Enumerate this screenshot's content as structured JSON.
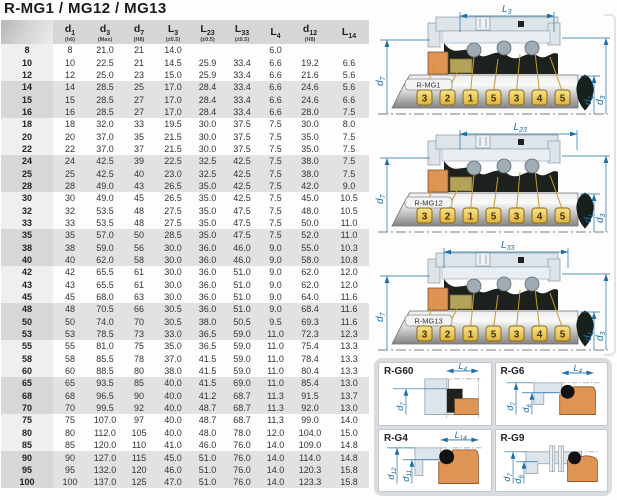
{
  "title": "R-MG1 / MG12 / MG13",
  "table": {
    "columns": [
      {
        "main": "",
        "sub": "",
        "note": ""
      },
      {
        "main": "d",
        "sub": "1",
        "note": "(h6)"
      },
      {
        "main": "d",
        "sub": "3",
        "note": "(Max)"
      },
      {
        "main": "d",
        "sub": "7",
        "note": "(H8)"
      },
      {
        "main": "L",
        "sub": "3",
        "note": "(±0.5)"
      },
      {
        "main": "L",
        "sub": "23",
        "note": "(±0.5)"
      },
      {
        "main": "L",
        "sub": "33",
        "note": "(±0.5)"
      },
      {
        "main": "L",
        "sub": "4",
        "note": ""
      },
      {
        "main": "d",
        "sub": "12",
        "note": "(H8)"
      },
      {
        "main": "L",
        "sub": "14",
        "note": ""
      }
    ],
    "rows": [
      [
        "8",
        "8",
        "21.0",
        "21",
        "14.0",
        "",
        "",
        "6.0",
        "",
        ""
      ],
      [
        "10",
        "10",
        "22.5",
        "21",
        "14.5",
        "25.9",
        "33.4",
        "6.6",
        "19.2",
        "6.6"
      ],
      [
        "12",
        "12",
        "25.0",
        "23",
        "15.0",
        "25.9",
        "33.4",
        "6.6",
        "21.6",
        "5.6"
      ],
      [
        "14",
        "14",
        "28.5",
        "25",
        "17.0",
        "28.4",
        "33.4",
        "6.6",
        "24.6",
        "5.6"
      ],
      [
        "15",
        "15",
        "28.5",
        "27",
        "17.0",
        "28.4",
        "33.4",
        "6.6",
        "24.6",
        "6.6"
      ],
      [
        "16",
        "16",
        "28.5",
        "27",
        "17.0",
        "28.4",
        "33.4",
        "6.6",
        "28.0",
        "7.5"
      ],
      [
        "18",
        "18",
        "32.0",
        "33",
        "19.5",
        "30.0",
        "37.5",
        "7.5",
        "30.0",
        "8.0"
      ],
      [
        "20",
        "20",
        "37.0",
        "35",
        "21.5",
        "30.0",
        "37.5",
        "7.5",
        "35.0",
        "7.5"
      ],
      [
        "22",
        "22",
        "37.0",
        "37",
        "21.5",
        "30.0",
        "37.5",
        "7.5",
        "35.0",
        "7.5"
      ],
      [
        "24",
        "24",
        "42.5",
        "39",
        "22.5",
        "32.5",
        "42.5",
        "7.5",
        "38.0",
        "7.5"
      ],
      [
        "25",
        "25",
        "42.5",
        "40",
        "23.0",
        "32.5",
        "42.5",
        "7.5",
        "38.0",
        "7.5"
      ],
      [
        "28",
        "28",
        "49.0",
        "43",
        "26.5",
        "35.0",
        "42.5",
        "7.5",
        "42.0",
        "9.0"
      ],
      [
        "30",
        "30",
        "49.0",
        "45",
        "26.5",
        "35.0",
        "42.5",
        "7.5",
        "45.0",
        "10.5"
      ],
      [
        "32",
        "32",
        "53.5",
        "48",
        "27.5",
        "35.0",
        "47.5",
        "7.5",
        "48.0",
        "10.5"
      ],
      [
        "33",
        "33",
        "53.5",
        "48",
        "27.5",
        "35.0",
        "47.5",
        "7.5",
        "50.0",
        "11.0"
      ],
      [
        "35",
        "35",
        "57.0",
        "50",
        "28.5",
        "35.0",
        "47.5",
        "7.5",
        "52.0",
        "11.0"
      ],
      [
        "38",
        "38",
        "59.0",
        "56",
        "30.0",
        "36.0",
        "46.0",
        "9.0",
        "55.0",
        "10.3"
      ],
      [
        "40",
        "40",
        "62.0",
        "58",
        "30.0",
        "36.0",
        "46.0",
        "9.0",
        "58.0",
        "10.8"
      ],
      [
        "42",
        "42",
        "65.5",
        "61",
        "30.0",
        "36.0",
        "51.0",
        "9.0",
        "62.0",
        "12.0"
      ],
      [
        "43",
        "43",
        "65.5",
        "61",
        "30.0",
        "36.0",
        "51.0",
        "9.0",
        "62.0",
        "12.0"
      ],
      [
        "45",
        "45",
        "68.0",
        "63",
        "30.0",
        "36.0",
        "51.0",
        "9.0",
        "64.0",
        "11.6"
      ],
      [
        "48",
        "48",
        "70.5",
        "66",
        "30.5",
        "36.0",
        "51.0",
        "9.0",
        "68.4",
        "11.6"
      ],
      [
        "50",
        "50",
        "74.0",
        "70",
        "30.5",
        "38.0",
        "50.5",
        "9.5",
        "69.3",
        "11.6"
      ],
      [
        "53",
        "53",
        "78.5",
        "73",
        "33.0",
        "36.5",
        "59.0",
        "11.0",
        "72.3",
        "12.3"
      ],
      [
        "55",
        "55",
        "81.0",
        "75",
        "35.0",
        "36.5",
        "59.0",
        "11.0",
        "75.4",
        "13.3"
      ],
      [
        "58",
        "58",
        "85.5",
        "78",
        "37.0",
        "41.5",
        "59.0",
        "11.0",
        "78.4",
        "13.3"
      ],
      [
        "60",
        "60",
        "88.5",
        "80",
        "38.0",
        "41.5",
        "59.0",
        "11.0",
        "80.4",
        "13.3"
      ],
      [
        "65",
        "65",
        "93.5",
        "85",
        "40.0",
        "41.5",
        "69.0",
        "11.0",
        "85.4",
        "13.0"
      ],
      [
        "68",
        "68",
        "96.5",
        "90",
        "40.0",
        "41.2",
        "68.7",
        "11.3",
        "91.5",
        "13.7"
      ],
      [
        "70",
        "70",
        "99.5",
        "92",
        "40.0",
        "48.7",
        "68.7",
        "11.3",
        "92.0",
        "13.0"
      ],
      [
        "75",
        "75",
        "107.0",
        "97",
        "40.0",
        "48.7",
        "68.7",
        "11.3",
        "99.0",
        "14.0"
      ],
      [
        "80",
        "80",
        "112.0",
        "105",
        "40.0",
        "48.0",
        "78.0",
        "12.0",
        "104.0",
        "15.0"
      ],
      [
        "85",
        "85",
        "120.0",
        "110",
        "41.0",
        "46.0",
        "76.0",
        "14.0",
        "109.0",
        "14.8"
      ],
      [
        "90",
        "90",
        "127.0",
        "115",
        "45.0",
        "51.0",
        "76.0",
        "14.0",
        "114.0",
        "14.8"
      ],
      [
        "95",
        "95",
        "132.0",
        "120",
        "46.0",
        "51.0",
        "76.0",
        "14.0",
        "120.3",
        "15.8"
      ],
      [
        "100",
        "100",
        "137.0",
        "125",
        "47.0",
        "51.0",
        "76.0",
        "14.0",
        "123.3",
        "15.8"
      ]
    ]
  },
  "diagrams": [
    {
      "label": "R-MG1",
      "top_dim": {
        "main": "L",
        "sub": "3"
      },
      "callouts": [
        "3",
        "2",
        "1",
        "5",
        "3",
        "4",
        "5"
      ],
      "left_dim": {
        "main": "d",
        "sub": "7"
      },
      "right_dims": [
        {
          "main": "d",
          "sub": "1"
        },
        {
          "main": "d",
          "sub": "3"
        }
      ]
    },
    {
      "label": "R-MG12",
      "top_dim": {
        "main": "L",
        "sub": "23"
      },
      "callouts": [
        "3",
        "2",
        "1",
        "5",
        "3",
        "4",
        "5"
      ],
      "left_dim": {
        "main": "d",
        "sub": "7"
      },
      "right_dims": [
        {
          "main": "d",
          "sub": "1"
        },
        {
          "main": "d",
          "sub": "3"
        }
      ]
    },
    {
      "label": "R-MG13",
      "top_dim": {
        "main": "L",
        "sub": "33"
      },
      "callouts": [
        "3",
        "2",
        "1",
        "5",
        "3",
        "4",
        "5"
      ],
      "left_dim": {
        "main": "d",
        "sub": "7"
      },
      "right_dims": [
        {
          "main": "d",
          "sub": "1"
        },
        {
          "main": "d",
          "sub": "3"
        }
      ]
    }
  ],
  "seat_panels": [
    {
      "label": "R-G60",
      "dim_top": {
        "main": "L",
        "sub": "4"
      },
      "dims_left": [
        {
          "main": "d",
          "sub": "7"
        }
      ]
    },
    {
      "label": "R-G6",
      "dim_top": {
        "main": "L",
        "sub": "4"
      },
      "dims_left": [
        {
          "main": "d",
          "sub": "7"
        },
        {
          "main": "d",
          "sub": "6"
        }
      ]
    },
    {
      "label": "R-G4",
      "dim_top": {
        "main": "L",
        "sub": "14"
      },
      "dims_left": [
        {
          "main": "d",
          "sub": "12"
        },
        {
          "main": "d",
          "sub": "11"
        }
      ]
    },
    {
      "label": "R-G9",
      "dim_top": null,
      "dims_left": [
        {
          "main": "d",
          "sub": "7"
        },
        {
          "main": "d",
          "sub": "6"
        }
      ]
    }
  ],
  "colors": {
    "dimension_blue": "#1d6fa5",
    "callout_yellow": "#f2cf5e",
    "callout_border": "#8a6a1e",
    "seat_orange": "#dd9455",
    "housing_steel": "#dde5eb",
    "rubber_black": "#1d211d",
    "olive_ring": "#b3a35a",
    "header_gray": "#d6d6d6",
    "stripe_gray": "#e2e2e2"
  }
}
